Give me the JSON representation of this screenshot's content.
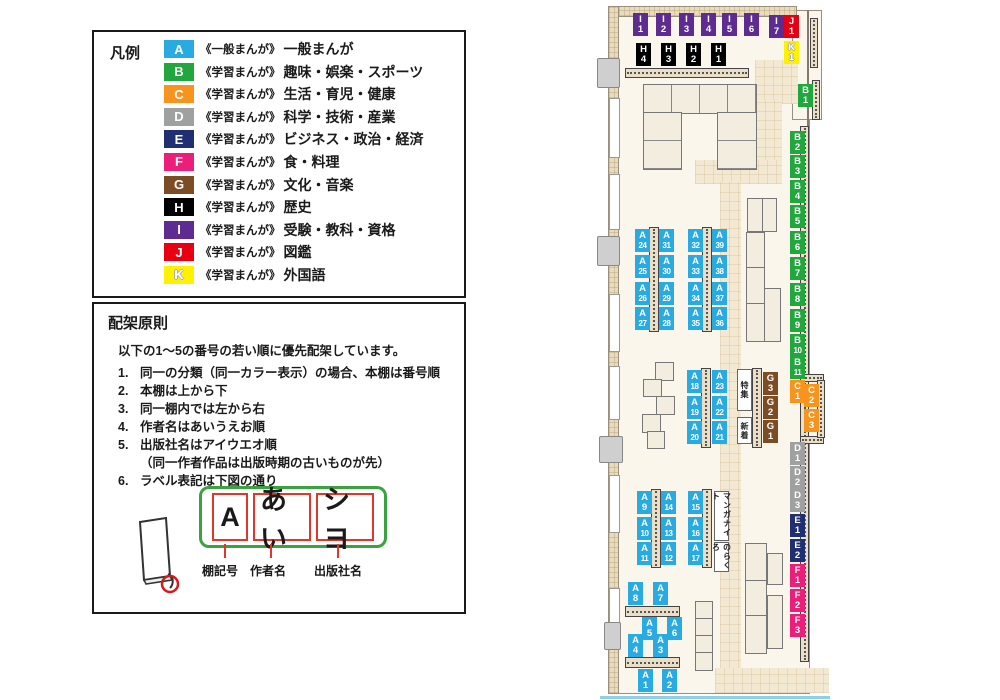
{
  "legend": {
    "title": "凡例",
    "items": [
      {
        "code": "A",
        "color": "#29ABE2",
        "series": "《一般まんが》",
        "label": "一般まんが"
      },
      {
        "code": "B",
        "color": "#21A73E",
        "series": "《学習まんが》",
        "label": "趣味・娯楽・スポーツ"
      },
      {
        "code": "C",
        "color": "#F7941E",
        "series": "《学習まんが》",
        "label": "生活・育児・健康"
      },
      {
        "code": "D",
        "color": "#9FA0A0",
        "series": "《学習まんが》",
        "label": "科学・技術・産業"
      },
      {
        "code": "E",
        "color": "#1F2F72",
        "series": "《学習まんが》",
        "label": "ビジネス・政治・経済"
      },
      {
        "code": "F",
        "color": "#EB1E79",
        "series": "《学習まんが》",
        "label": "食・料理"
      },
      {
        "code": "G",
        "color": "#7C4D24",
        "series": "《学習まんが》",
        "label": "文化・音楽"
      },
      {
        "code": "H",
        "color": "#000000",
        "series": "《学習まんが》",
        "label": "歴史"
      },
      {
        "code": "I",
        "color": "#5E2C90",
        "series": "《学習まんが》",
        "label": "受験・教科・資格"
      },
      {
        "code": "J",
        "color": "#E60012",
        "series": "《学習まんが》",
        "label": "図鑑"
      },
      {
        "code": "K",
        "color": "#FFF100",
        "series": "《学習まんが》",
        "label": "外国語"
      }
    ]
  },
  "principles": {
    "title": "配架原則",
    "intro": "以下の1～5の番号の若い順に優先配架しています。",
    "rules": [
      {
        "num": "1.",
        "text": "同一の分類（同一カラー表示）の場合、本棚は番号順"
      },
      {
        "num": "2.",
        "text": "本棚は上から下"
      },
      {
        "num": "3.",
        "text": "同一棚内では左から右"
      },
      {
        "num": "4.",
        "text": "作者名はあいうえお順"
      },
      {
        "num": "5.",
        "text": "出版社名はアイウエオ順",
        "sub": "（同一作者作品は出版時期の古いものが先）"
      },
      {
        "num": "6.",
        "text": "ラベル表記は下図の通り"
      }
    ],
    "diagram": {
      "parts": [
        {
          "text": "A",
          "caption": "棚記号",
          "box_w": 36,
          "leader_x": 130,
          "caption_x": 108
        },
        {
          "text": "あい",
          "caption": "作者名",
          "box_w": 58,
          "leader_x": 176,
          "caption_x": 156
        },
        {
          "text": "シヨ",
          "caption": "出版社名",
          "box_w": 58,
          "leader_x": 243,
          "caption_x": 220
        }
      ]
    }
  },
  "map": {
    "colors": {
      "A": "#29ABE2",
      "B": "#21A73E",
      "C": "#F7941E",
      "D": "#9FA0A0",
      "E": "#1F2F72",
      "F": "#EB1E79",
      "G": "#7C4D24",
      "H": "#000000",
      "I": "#5E2C90",
      "J": "#E60012",
      "K": "#FFF100"
    },
    "labels": [
      {
        "c": "I",
        "n": "1",
        "x": 38,
        "y": 13
      },
      {
        "c": "I",
        "n": "2",
        "x": 61,
        "y": 13
      },
      {
        "c": "I",
        "n": "3",
        "x": 84,
        "y": 13
      },
      {
        "c": "I",
        "n": "4",
        "x": 106,
        "y": 13
      },
      {
        "c": "I",
        "n": "5",
        "x": 127,
        "y": 13
      },
      {
        "c": "I",
        "n": "6",
        "x": 149,
        "y": 13
      },
      {
        "c": "H",
        "n": "4",
        "x": 41,
        "y": 43
      },
      {
        "c": "H",
        "n": "3",
        "x": 66,
        "y": 43
      },
      {
        "c": "H",
        "n": "2",
        "x": 91,
        "y": 43
      },
      {
        "c": "H",
        "n": "1",
        "x": 116,
        "y": 43
      },
      {
        "c": "I",
        "n": "7",
        "x": 174,
        "y": 15
      },
      {
        "c": "J",
        "n": "1",
        "x": 189,
        "y": 15
      },
      {
        "c": "K",
        "n": "1",
        "x": 189,
        "y": 41
      },
      {
        "c": "B",
        "n": "1",
        "x": 203,
        "y": 84
      },
      {
        "c": "B",
        "n": "2",
        "x": 195,
        "y": 131
      },
      {
        "c": "B",
        "n": "3",
        "x": 195,
        "y": 155
      },
      {
        "c": "B",
        "n": "4",
        "x": 195,
        "y": 180
      },
      {
        "c": "B",
        "n": "5",
        "x": 195,
        "y": 205
      },
      {
        "c": "B",
        "n": "6",
        "x": 195,
        "y": 231
      },
      {
        "c": "B",
        "n": "7",
        "x": 195,
        "y": 257
      },
      {
        "c": "B",
        "n": "8",
        "x": 195,
        "y": 283
      },
      {
        "c": "B",
        "n": "9",
        "x": 195,
        "y": 309
      },
      {
        "c": "B",
        "n": "10",
        "x": 195,
        "y": 334
      },
      {
        "c": "B",
        "n": "11",
        "x": 195,
        "y": 356
      },
      {
        "c": "C",
        "n": "1",
        "x": 195,
        "y": 380
      },
      {
        "c": "C",
        "n": "2",
        "x": 209,
        "y": 384
      },
      {
        "c": "C",
        "n": "3",
        "x": 209,
        "y": 409
      },
      {
        "c": "D",
        "n": "1",
        "x": 195,
        "y": 442
      },
      {
        "c": "D",
        "n": "2",
        "x": 195,
        "y": 466
      },
      {
        "c": "D",
        "n": "3",
        "x": 195,
        "y": 489
      },
      {
        "c": "E",
        "n": "1",
        "x": 195,
        "y": 514
      },
      {
        "c": "E",
        "n": "2",
        "x": 195,
        "y": 539
      },
      {
        "c": "F",
        "n": "1",
        "x": 195,
        "y": 564
      },
      {
        "c": "F",
        "n": "2",
        "x": 195,
        "y": 589
      },
      {
        "c": "F",
        "n": "3",
        "x": 195,
        "y": 614
      },
      {
        "c": "A",
        "n": "24",
        "x": 40,
        "y": 229
      },
      {
        "c": "A",
        "n": "31",
        "x": 64,
        "y": 229
      },
      {
        "c": "A",
        "n": "25",
        "x": 40,
        "y": 255
      },
      {
        "c": "A",
        "n": "30",
        "x": 64,
        "y": 255
      },
      {
        "c": "A",
        "n": "26",
        "x": 40,
        "y": 282
      },
      {
        "c": "A",
        "n": "29",
        "x": 64,
        "y": 282
      },
      {
        "c": "A",
        "n": "27",
        "x": 40,
        "y": 307
      },
      {
        "c": "A",
        "n": "28",
        "x": 64,
        "y": 307
      },
      {
        "c": "A",
        "n": "32",
        "x": 93,
        "y": 229
      },
      {
        "c": "A",
        "n": "39",
        "x": 117,
        "y": 229
      },
      {
        "c": "A",
        "n": "33",
        "x": 93,
        "y": 255
      },
      {
        "c": "A",
        "n": "38",
        "x": 117,
        "y": 255
      },
      {
        "c": "A",
        "n": "34",
        "x": 93,
        "y": 282
      },
      {
        "c": "A",
        "n": "37",
        "x": 117,
        "y": 282
      },
      {
        "c": "A",
        "n": "35",
        "x": 93,
        "y": 307
      },
      {
        "c": "A",
        "n": "36",
        "x": 117,
        "y": 307
      },
      {
        "c": "A",
        "n": "18",
        "x": 92,
        "y": 370
      },
      {
        "c": "A",
        "n": "23",
        "x": 117,
        "y": 370
      },
      {
        "c": "A",
        "n": "19",
        "x": 92,
        "y": 396
      },
      {
        "c": "A",
        "n": "22",
        "x": 117,
        "y": 396
      },
      {
        "c": "A",
        "n": "20",
        "x": 92,
        "y": 421
      },
      {
        "c": "A",
        "n": "21",
        "x": 117,
        "y": 421
      },
      {
        "c": "G",
        "n": "3",
        "x": 168,
        "y": 372
      },
      {
        "c": "G",
        "n": "2",
        "x": 168,
        "y": 396
      },
      {
        "c": "G",
        "n": "1",
        "x": 168,
        "y": 420
      },
      {
        "c": "A",
        "n": "9",
        "x": 42,
        "y": 491
      },
      {
        "c": "A",
        "n": "14",
        "x": 66,
        "y": 491
      },
      {
        "c": "A",
        "n": "10",
        "x": 42,
        "y": 517
      },
      {
        "c": "A",
        "n": "13",
        "x": 66,
        "y": 517
      },
      {
        "c": "A",
        "n": "11",
        "x": 42,
        "y": 542
      },
      {
        "c": "A",
        "n": "12",
        "x": 66,
        "y": 542
      },
      {
        "c": "A",
        "n": "15",
        "x": 93,
        "y": 491
      },
      {
        "c": "A",
        "n": "16",
        "x": 93,
        "y": 517
      },
      {
        "c": "A",
        "n": "17",
        "x": 93,
        "y": 542
      },
      {
        "c": "A",
        "n": "8",
        "x": 33,
        "y": 582
      },
      {
        "c": "A",
        "n": "7",
        "x": 58,
        "y": 582
      },
      {
        "c": "A",
        "n": "5",
        "x": 47,
        "y": 617
      },
      {
        "c": "A",
        "n": "6",
        "x": 72,
        "y": 617
      },
      {
        "c": "A",
        "n": "4",
        "x": 33,
        "y": 634
      },
      {
        "c": "A",
        "n": "3",
        "x": 58,
        "y": 634
      },
      {
        "c": "A",
        "n": "1",
        "x": 43,
        "y": 669
      },
      {
        "c": "A",
        "n": "2",
        "x": 67,
        "y": 669
      }
    ],
    "boxes": [
      {
        "text": "特集",
        "x": 142,
        "y": 369,
        "h": 40
      },
      {
        "text": "新着",
        "x": 142,
        "y": 417,
        "h": 25
      },
      {
        "text": "マンガナイト",
        "x": 119,
        "y": 491,
        "h": 48
      },
      {
        "text": "のらくろ",
        "x": 119,
        "y": 542,
        "h": 28
      }
    ]
  }
}
